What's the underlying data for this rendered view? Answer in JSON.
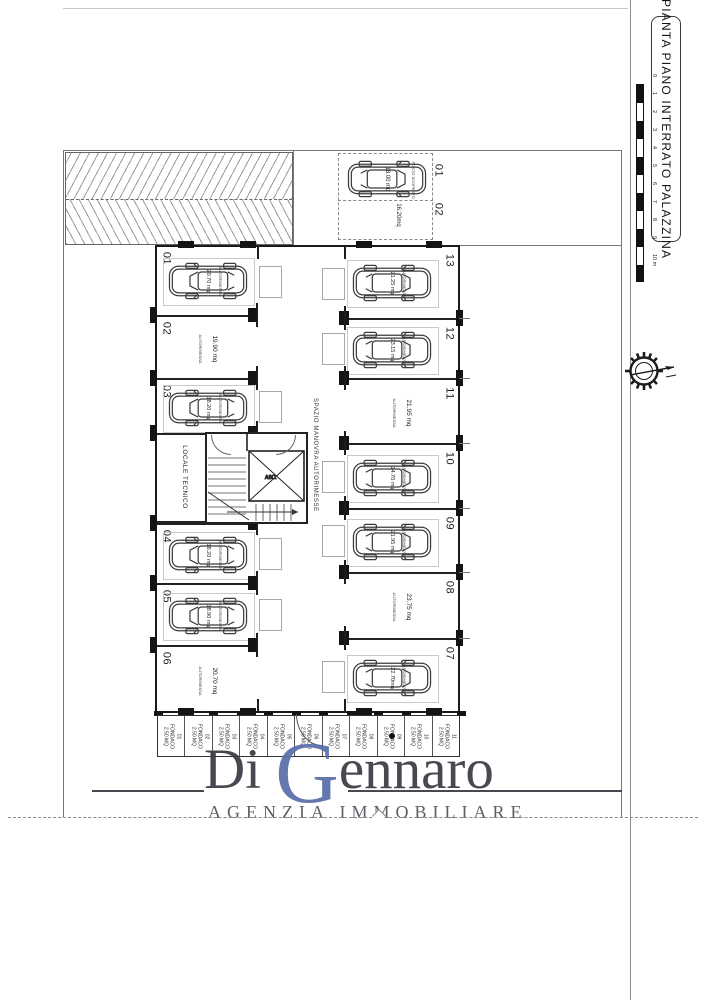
{
  "title_block": {
    "title": "PIANTA PIANO INTERRATO PALAZZINA"
  },
  "scale_bar": {
    "unit_labels": [
      "0",
      "1",
      "2",
      "3",
      "4",
      "5",
      "6",
      "7",
      "8",
      "9",
      "10 m"
    ]
  },
  "plan": {
    "corridor_label": "SPAZIO MANOVRA AUTORIMESSE",
    "tech_room_label": "LOCALE TECNICO",
    "elevator_label": "ASCENSORE",
    "room_type_label": "AUTORIMESSA",
    "outdoor": {
      "spot1": {
        "num": "01",
        "area": "18.00 mq",
        "note": "POSTO SCOPERTO"
      },
      "spot2": {
        "num": "02",
        "area": "16.20mq"
      }
    },
    "left_garages": [
      {
        "num": "01",
        "area": "20.70 mq",
        "car": true
      },
      {
        "num": "02",
        "area": "19.90 mq",
        "car": false
      },
      {
        "num": "03",
        "area": "18.20 mq",
        "car": true
      },
      {
        "num": "04",
        "area": "18.20 mq",
        "car": true
      },
      {
        "num": "05",
        "area": "18.90 mq",
        "car": true
      },
      {
        "num": "06",
        "area": "20.70 mq",
        "car": false
      }
    ],
    "right_garages": [
      {
        "num": "13",
        "area": "21.25 mq",
        "car": true
      },
      {
        "num": "12",
        "area": "23.15 mq",
        "car": true
      },
      {
        "num": "11",
        "area": "21.95 mq",
        "car": false
      },
      {
        "num": "10",
        "area": "24.70 mq",
        "car": true
      },
      {
        "num": "09",
        "area": "21.95 mq",
        "car": true
      },
      {
        "num": "08",
        "area": "23.75 mq",
        "car": false
      },
      {
        "num": "07",
        "area": "22.70mq",
        "car": true
      }
    ],
    "storage_cells": [
      {
        "num": "01",
        "label": "FONDACO",
        "area": "2.50 MQ"
      },
      {
        "num": "02",
        "label": "FONDACO",
        "area": "2.50 MQ"
      },
      {
        "num": "03",
        "label": "FONDACO",
        "area": "2.50 MQ"
      },
      {
        "num": "04",
        "label": "FONDACO",
        "area": "2.50 MQ"
      },
      {
        "num": "05",
        "label": "FONDACO",
        "area": "2.50 MQ"
      },
      {
        "num": "06",
        "label": "FONDACO",
        "area": "2.50 MQ"
      },
      {
        "num": "07",
        "label": "FONDACO",
        "area": "2.50 MQ"
      },
      {
        "num": "08",
        "label": "FONDACO",
        "area": "2.50 MQ"
      },
      {
        "num": "09",
        "label": "FONDACO",
        "area": "2.50 MQ"
      },
      {
        "num": "10",
        "label": "FONDACO",
        "area": "2.50 MQ"
      },
      {
        "num": "11",
        "label": "FONDACO",
        "area": "2.50 MQ"
      }
    ]
  },
  "logo": {
    "prefix": "Di ",
    "initial": "G",
    "rest": "ennaro",
    "subtitle": "AGENZIA IMMOBILIARE",
    "initial_color": "#5b6fa9",
    "text_color": "#3d3d46"
  }
}
